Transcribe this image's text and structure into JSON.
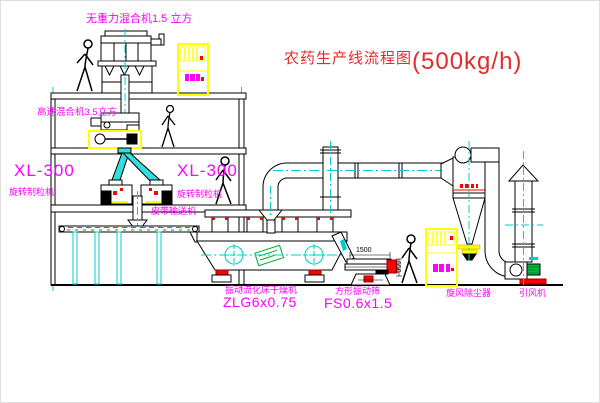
{
  "title": {
    "text": "农药生产线流程图",
    "capacity": "(500kg/h)"
  },
  "labels": {
    "gravity_mixer": "无重力混合机1.5 立方",
    "high_speed_mixer": "高速混合机3.5立方",
    "granulator_left_model": "XL-300",
    "granulator_left_name": "旋转制粒机",
    "granulator_mid_model": "XL-300",
    "granulator_mid_name": "旋转制粒机",
    "belt_conveyor": "皮带输送机",
    "dryer_name": "振动流化床干燥机",
    "dryer_model": "ZLG6x0.75",
    "sieve_name": "方形振动筛",
    "sieve_model": "FS0.6x1.5",
    "cyclone": "旋风除尘器",
    "fan": "引风机"
  },
  "dimensions": {
    "sieve_length": "1500",
    "sieve_height": "550"
  },
  "colors": {
    "label_magenta": "#FF00FF",
    "title_red": "#E22B2B",
    "line_black": "#000000",
    "centerline_cyan": "#00CCCC",
    "equipment_yellow": "#FFFF00",
    "accent_red": "#FF0000",
    "motor_green": "#00BB44"
  }
}
